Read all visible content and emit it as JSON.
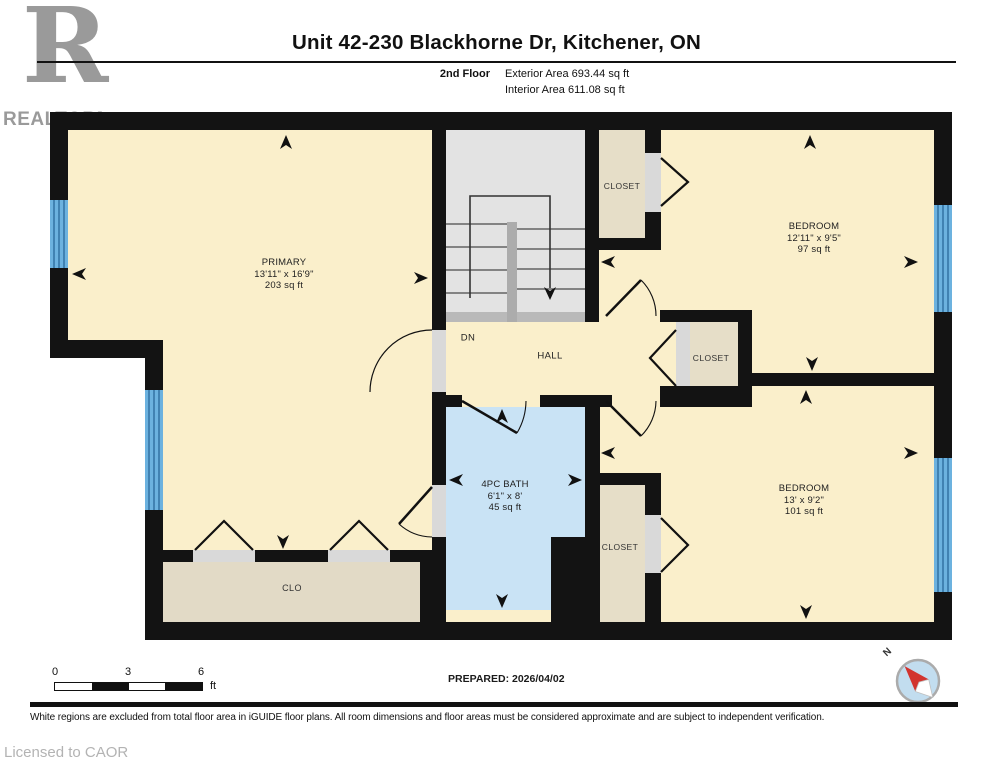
{
  "header": {
    "title": "Unit 42-230 Blackhorne Dr, Kitchener, ON",
    "floor_label": "2nd Floor",
    "exterior_area": "Exterior Area 693.44 sq ft",
    "interior_area": "Interior Area 611.08 sq ft",
    "logo": {
      "letter": "R",
      "wordmark": "REALTOR",
      "registered": "®"
    }
  },
  "rooms": {
    "primary": {
      "name": "PRIMARY",
      "dims": "13'11\" x 16'9\"",
      "area": "203 sq ft"
    },
    "bedroom_top": {
      "name": "BEDROOM",
      "dims": "12'11\" x 9'5\"",
      "area": "97 sq ft"
    },
    "bedroom_bottom": {
      "name": "BEDROOM",
      "dims": "13' x 9'2\"",
      "area": "101 sq ft"
    },
    "bath": {
      "name": "4PC BATH",
      "dims": "6'1\" x 8'",
      "area": "45 sq ft"
    },
    "hall": {
      "name": "HALL"
    },
    "stairs_direction": "DN",
    "closet_top": "CLOSET",
    "closet_mid": "CLOSET",
    "closet_bottom": "CLOSET",
    "closet_primary": "CLO"
  },
  "footer": {
    "scale": {
      "ticks": [
        "0",
        "3",
        "6"
      ],
      "unit": "ft"
    },
    "prepared": "PREPARED: 2026/04/02",
    "compass_label": "N",
    "disclaimer": "White regions are excluded from total floor area in iGUIDE floor plans. All room dimensions and floor areas must be considered approximate and are subject to independent verification.",
    "license": "Licensed to CAOR"
  },
  "colors": {
    "wall": "#131313",
    "room_cream": "#FAEFCB",
    "closet_beige": "#E6DEC8",
    "bath_blue": "#C9E3F5",
    "stairs_grey": "#E3E3E3",
    "window_blue": "#6CB2DF",
    "compass_red": "#D2342E",
    "logo_grey": "#9A9A9A"
  }
}
